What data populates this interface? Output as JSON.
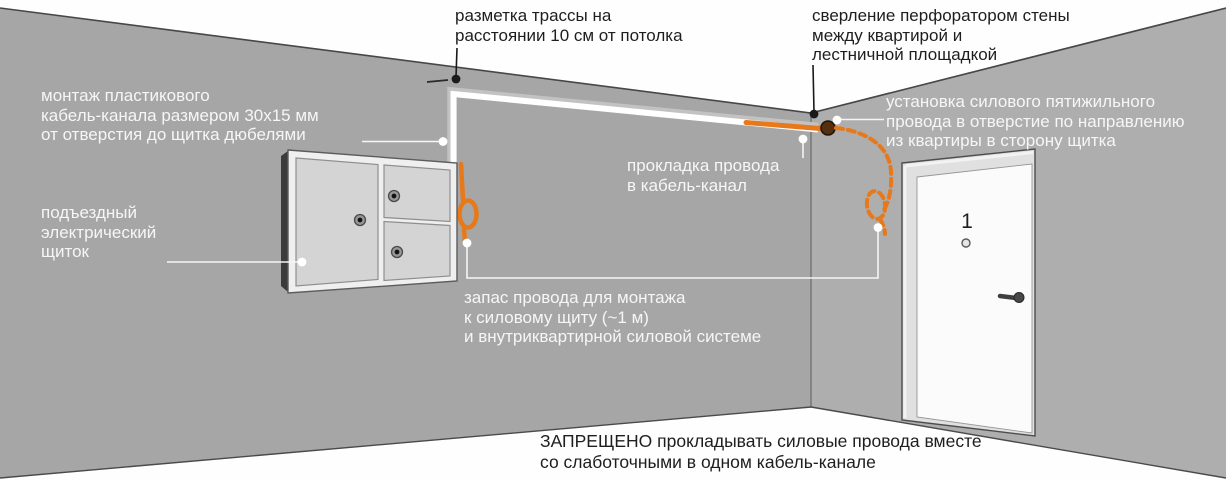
{
  "title": "Схема прокладки силового провода от квартиры к подъездному щитку",
  "labels": {
    "marking_route": "разметка трассы на\nрасстоянии 10 см от потолка",
    "drilling": "сверление перфоратором стены\nмежду квартирой и\nлестничной площадкой",
    "channel_mount": "монтаж пластикового\nкабель-канала размером 30x15 мм\nот отверстия до щитка дюбелями",
    "panel_label": "подъездный\nэлектрический\nщиток",
    "wire_laying": "прокладка провода\nв кабель-канал",
    "wire_through_hole": "установка силового пятижильного\nпровода в отверстие по направлению\nиз квартиры в сторону щитка",
    "wire_reserve": "запас провода для монтажа\nк силовому щиту (~1 м)\nи внутриквартирной силовой системе",
    "prohibition": "ЗАПРЕЩЕНО прокладывать силовые провода вместе\nсо слаботочными в одном кабель-канале"
  },
  "door": {
    "number": "1"
  },
  "colors": {
    "wall_left": "#a6a6a6",
    "wall_right": "#aeaeae",
    "ceiling_floor": "#fefefe",
    "cable_channel": "#ffffff",
    "wire_orange": "#e8791a",
    "hole_brown": "#53300f",
    "panel_face": "#d4d4d4",
    "door_white": "#fbfbfb",
    "text_light": "#f6f6f6",
    "text_dark": "#1e1e1e"
  }
}
